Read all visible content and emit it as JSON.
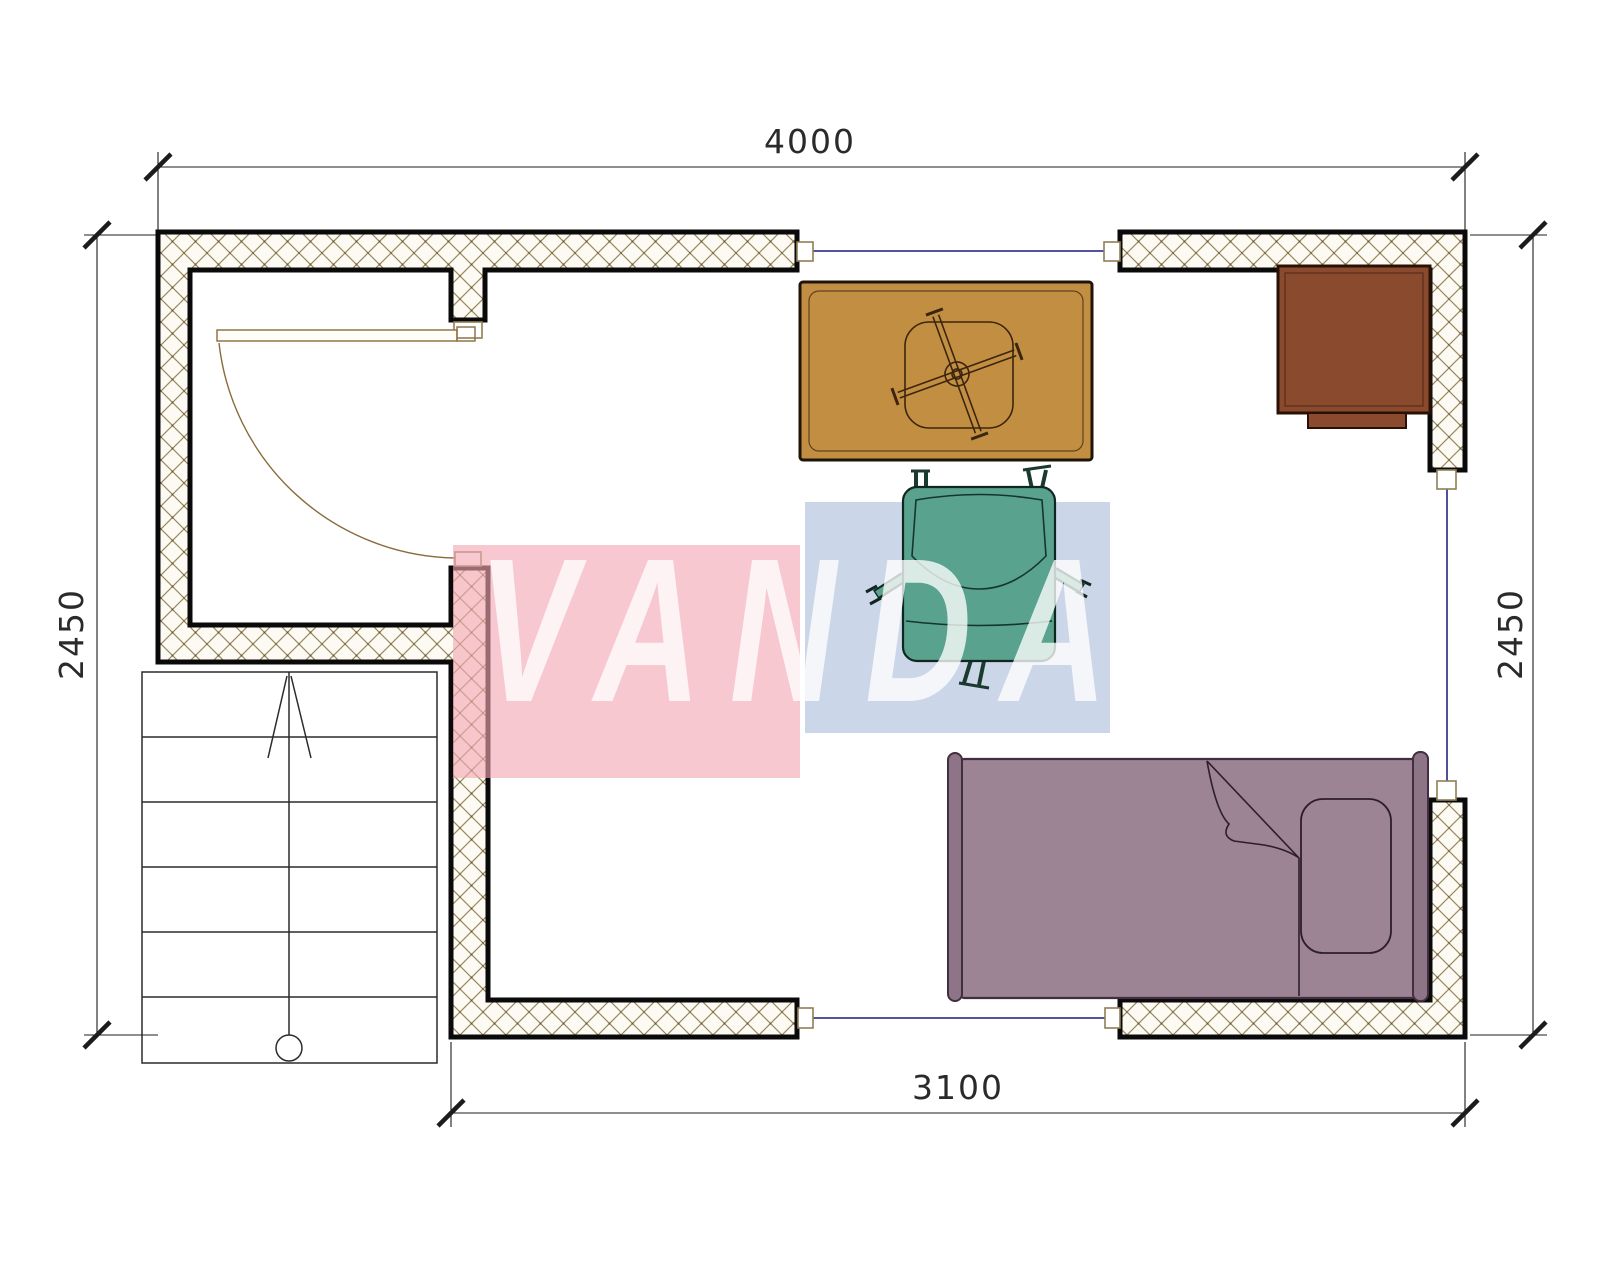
{
  "watermark": {
    "brand": "VANDA"
  },
  "dimensions": {
    "top": "4000",
    "bottom": "3100",
    "left": "2450",
    "right": "2450"
  },
  "plan": {
    "type": "floor-plan",
    "furniture": [
      "rug-with-pedestal-table",
      "cabinet",
      "office-chair",
      "single-bed",
      "staircase",
      "swing-door"
    ],
    "colors": {
      "wall_hatch_line": "#97895f",
      "wall_outline": "#0a0a0a",
      "window_line": "#3b3b8f",
      "rug": "#c28f42",
      "cabinet": "#8a4a2e",
      "chair": "#58a28e",
      "bed": "#9c8495",
      "watermark_pink": "#f2a6b1",
      "watermark_blue": "#b7c8df",
      "watermark_text": "#ffffff"
    }
  }
}
